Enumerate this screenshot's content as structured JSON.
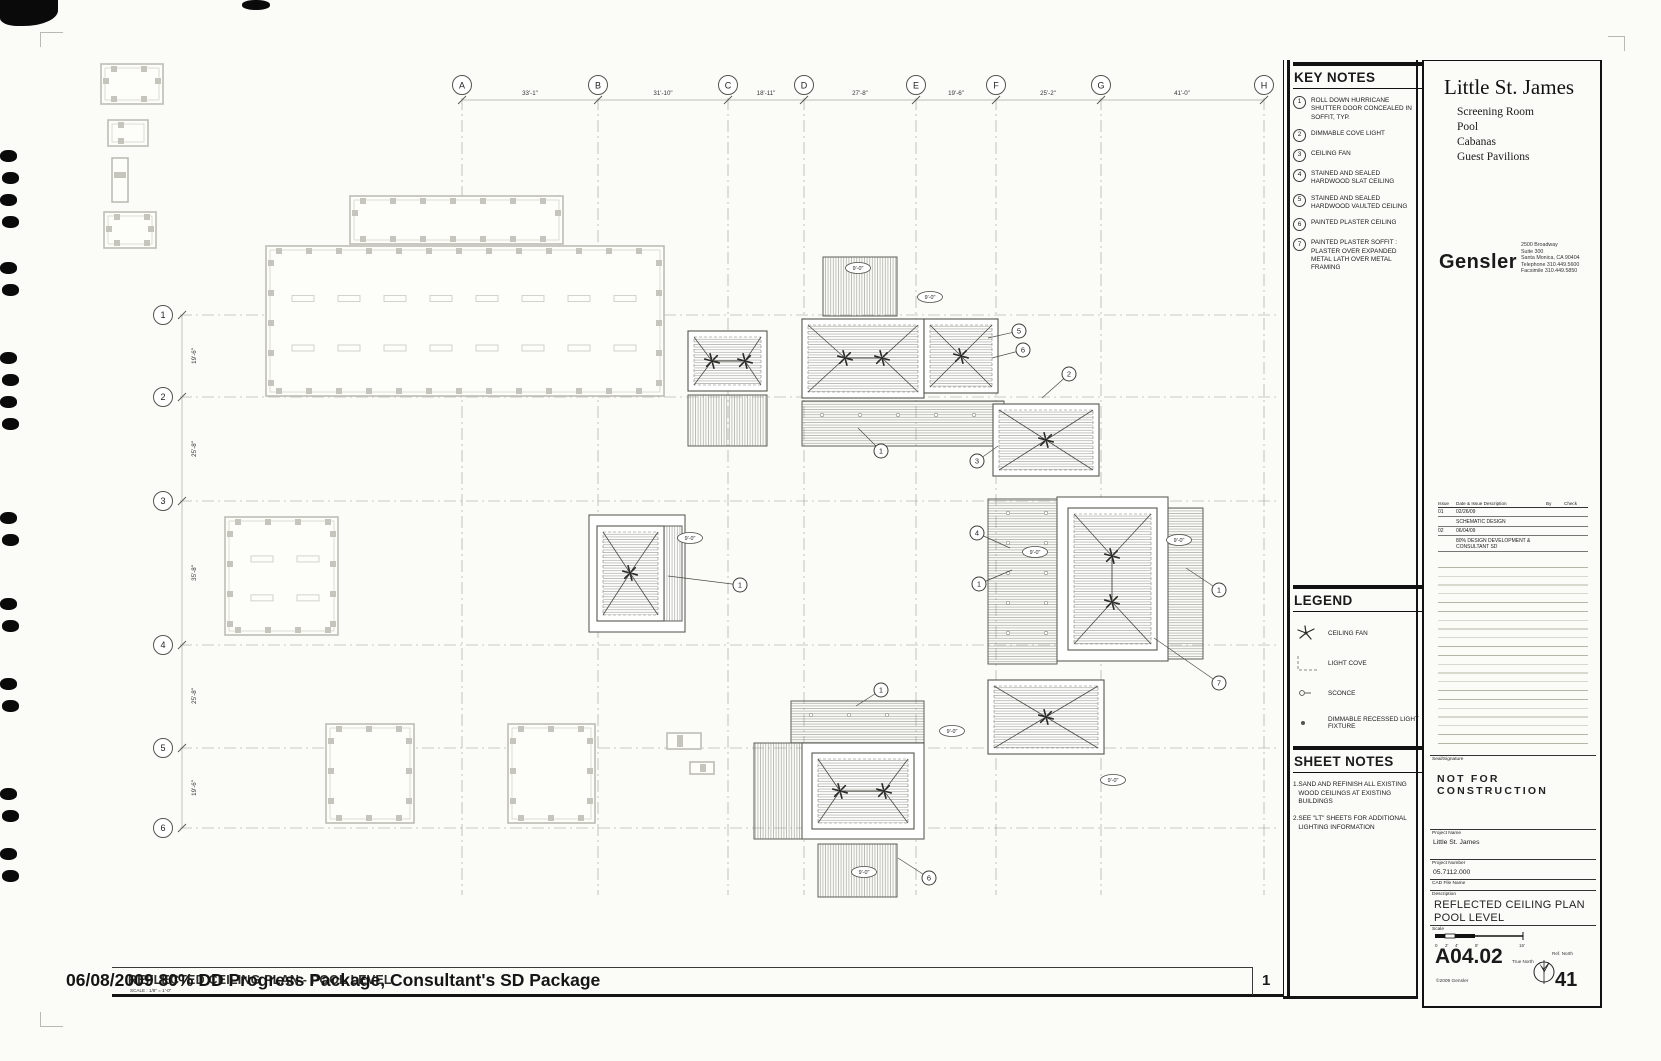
{
  "colors": {
    "ink": "#1a1a1a",
    "plan_line": "#55554f",
    "existing_gray": "#bdbdb5",
    "hatch": "#90908a"
  },
  "sheet": {
    "stamp_overlay": "06/08/2009 80% DD Progress Package, Consultant's SD Package",
    "drawing_title": "REFLECTED CEILING PLAN - POOL LEVEL",
    "drawing_scale_note": "SCALE : 1/8\" = 1'-0\"",
    "detail_number": "1"
  },
  "key_notes": {
    "title": "KEY NOTES",
    "items": [
      {
        "num": "1",
        "text": "ROLL DOWN HURRICANE SHUTTER DOOR CONCEALED IN SOFFIT, TYP."
      },
      {
        "num": "2",
        "text": "DIMMABLE COVE LIGHT"
      },
      {
        "num": "3",
        "text": "CEILING FAN"
      },
      {
        "num": "4",
        "text": "STAINED AND SEALED HARDWOOD SLAT CEILING"
      },
      {
        "num": "5",
        "text": "STAINED AND SEALED HARDWOOD VAULTED CEILING"
      },
      {
        "num": "6",
        "text": "PAINTED PLASTER CEILING"
      },
      {
        "num": "7",
        "text": "PAINTED PLASTER SOFFIT : PLASTER OVER EXPANDED METAL LATH OVER METAL FRAMING"
      }
    ]
  },
  "legend": {
    "title": "LEGEND",
    "items": [
      {
        "symbol": "ceiling-fan",
        "label": "CEILING FAN"
      },
      {
        "symbol": "light-cove",
        "label": "LIGHT COVE"
      },
      {
        "symbol": "sconce",
        "label": "SCONCE"
      },
      {
        "symbol": "dimmable-recessed",
        "label": "DIMMABLE RECESSED LIGHT FIXTURE"
      }
    ]
  },
  "sheet_notes": {
    "title": "SHEET NOTES",
    "items": [
      {
        "num": "1.",
        "text": "SAND AND REFINISH ALL EXISTING WOOD CEILINGS AT EXISTING BUILDINGS"
      },
      {
        "num": "2.",
        "text": "SEE \"LT\" SHEETS FOR ADDITIONAL LIGHTING INFORMATION"
      }
    ]
  },
  "title_block": {
    "project_title": "Little St. James",
    "project_subtitles": [
      "Screening Room",
      "Pool",
      "Cabanas",
      "Guest Pavilions"
    ],
    "firm": "Gensler",
    "address_lines": [
      "2500 Broadway",
      "Suite 300",
      "Santa Monica, CA 90404",
      "Telephone 310.449.5600",
      "Facsimile 310.449.5850"
    ],
    "issue_table": {
      "headers": [
        "Issue",
        "Date & Issue Description",
        "By",
        "Check"
      ],
      "rows": [
        [
          "01",
          "02/26/09",
          "",
          ""
        ],
        [
          "",
          "SCHEMATIC DESIGN",
          "",
          ""
        ],
        [
          "02",
          "06/04/09",
          "",
          ""
        ],
        [
          "",
          "80% DESIGN DEVELOPMENT & CONSULTANT SD",
          "",
          ""
        ]
      ]
    },
    "seal_label": "Seal/Signature",
    "not_for_construction": "NOT FOR CONSTRUCTION",
    "project_name_label": "Project Name",
    "project_name": "Little St. James",
    "project_number_label": "Project Number",
    "project_number": "05.7112.000",
    "cad_label": "CAD File Name",
    "description_label": "Description",
    "description_line1": "REFLECTED CEILING PLAN",
    "description_line2": "POOL LEVEL",
    "scale_label": "Scale",
    "scale_ticks": [
      "0",
      "2'",
      "4'",
      "8'",
      "16'"
    ],
    "sheet_number": "A04.02",
    "copyright": "©2009 Gensler",
    "true_north_label": "True North",
    "ref_north_label": "Ref. North",
    "page_number": "41"
  },
  "grid": {
    "columns": [
      {
        "label": "A",
        "x": 462
      },
      {
        "label": "B",
        "x": 598
      },
      {
        "label": "C",
        "x": 728
      },
      {
        "label": "D",
        "x": 804
      },
      {
        "label": "E",
        "x": 916
      },
      {
        "label": "F",
        "x": 996
      },
      {
        "label": "G",
        "x": 1101
      },
      {
        "label": "H",
        "x": 1264
      }
    ],
    "col_dims": [
      {
        "text": "33'-1\"",
        "x": 530
      },
      {
        "text": "31'-10\"",
        "x": 663
      },
      {
        "text": "18'-11\"",
        "x": 766
      },
      {
        "text": "27'-8\"",
        "x": 860
      },
      {
        "text": "19'-6\"",
        "x": 956
      },
      {
        "text": "25'-2\"",
        "x": 1048
      },
      {
        "text": "41'-0\"",
        "x": 1182
      }
    ],
    "rows": [
      {
        "label": "1",
        "y": 315
      },
      {
        "label": "2",
        "y": 397
      },
      {
        "label": "3",
        "y": 501
      },
      {
        "label": "4",
        "y": 645
      },
      {
        "label": "5",
        "y": 748
      },
      {
        "label": "6",
        "y": 828
      }
    ],
    "row_dims": [
      {
        "text": "19'-6\"",
        "y": 356
      },
      {
        "text": "25'-8\"",
        "y": 449
      },
      {
        "text": "35'-8\"",
        "y": 573
      },
      {
        "text": "25'-8\"",
        "y": 696
      },
      {
        "text": "19'-6\"",
        "y": 788
      }
    ]
  },
  "plan": {
    "buildings": [
      {
        "type": "existing",
        "x": 101,
        "y": 64,
        "w": 62,
        "h": 40
      },
      {
        "type": "existing",
        "x": 108,
        "y": 120,
        "w": 40,
        "h": 26
      },
      {
        "type": "existing",
        "x": 112,
        "y": 158,
        "w": 16,
        "h": 44
      },
      {
        "type": "existing",
        "x": 104,
        "y": 212,
        "w": 52,
        "h": 36
      },
      {
        "type": "existing",
        "x": 350,
        "y": 196,
        "w": 213,
        "h": 48
      },
      {
        "type": "existing",
        "x": 266,
        "y": 246,
        "w": 398,
        "h": 150,
        "bars": true
      },
      {
        "type": "existing",
        "x": 225,
        "y": 517,
        "w": 113,
        "h": 118,
        "bars": true
      },
      {
        "type": "existing",
        "x": 326,
        "y": 724,
        "w": 88,
        "h": 99
      },
      {
        "type": "existing",
        "x": 508,
        "y": 724,
        "w": 87,
        "h": 99
      },
      {
        "type": "existing",
        "x": 667,
        "y": 733,
        "w": 34,
        "h": 16
      },
      {
        "type": "existing",
        "x": 690,
        "y": 762,
        "w": 24,
        "h": 12
      },
      {
        "type": "vault",
        "x": 688,
        "y": 331,
        "w": 79,
        "h": 60,
        "fans": [
          [
            712,
            361
          ],
          [
            745,
            361
          ]
        ]
      },
      {
        "type": "slatv",
        "x": 688,
        "y": 395,
        "w": 79,
        "h": 51
      },
      {
        "type": "slatv",
        "x": 823,
        "y": 257,
        "w": 74,
        "h": 59
      },
      {
        "type": "vault",
        "x": 802,
        "y": 319,
        "w": 122,
        "h": 79,
        "fans": [
          [
            845,
            358
          ],
          [
            882,
            358
          ]
        ]
      },
      {
        "type": "vault",
        "x": 924,
        "y": 319,
        "w": 74,
        "h": 74,
        "fans": [
          [
            961,
            356
          ]
        ]
      },
      {
        "type": "slat",
        "x": 802,
        "y": 401,
        "w": 202,
        "h": 45,
        "dots": true
      },
      {
        "type": "vault",
        "x": 993,
        "y": 404,
        "w": 106,
        "h": 72,
        "fans": [
          [
            1046,
            440
          ]
        ]
      },
      {
        "type": "slat",
        "x": 988,
        "y": 499,
        "w": 69,
        "h": 165,
        "dots": true
      },
      {
        "type": "plain",
        "x": 1057,
        "y": 497,
        "w": 111,
        "h": 164
      },
      {
        "type": "vault",
        "x": 1068,
        "y": 508,
        "w": 89,
        "h": 142,
        "fans": [
          [
            1112,
            556
          ],
          [
            1112,
            602
          ]
        ]
      },
      {
        "type": "slat",
        "x": 1168,
        "y": 508,
        "w": 35,
        "h": 151
      },
      {
        "type": "vault",
        "x": 988,
        "y": 680,
        "w": 116,
        "h": 74,
        "fans": [
          [
            1046,
            717
          ]
        ]
      },
      {
        "type": "slat",
        "x": 791,
        "y": 701,
        "w": 133,
        "h": 42,
        "dots": true
      },
      {
        "type": "slatv",
        "x": 754,
        "y": 743,
        "w": 48,
        "h": 96
      },
      {
        "type": "plain",
        "x": 802,
        "y": 743,
        "w": 122,
        "h": 96
      },
      {
        "type": "vault",
        "x": 812,
        "y": 753,
        "w": 102,
        "h": 76,
        "fans": [
          [
            840,
            791
          ],
          [
            884,
            791
          ]
        ]
      },
      {
        "type": "slatv",
        "x": 818,
        "y": 844,
        "w": 79,
        "h": 53
      },
      {
        "type": "plain",
        "x": 589,
        "y": 515,
        "w": 96,
        "h": 117
      },
      {
        "type": "vault",
        "x": 597,
        "y": 526,
        "w": 67,
        "h": 95,
        "fans": [
          [
            630,
            573
          ]
        ]
      },
      {
        "type": "slatv",
        "x": 664,
        "y": 526,
        "w": 18,
        "h": 95
      }
    ],
    "keynote_refs": [
      {
        "n": "5",
        "x": 1019,
        "y": 331,
        "lx": 988,
        "ly": 338
      },
      {
        "n": "6",
        "x": 1023,
        "y": 350,
        "lx": 992,
        "ly": 358
      },
      {
        "n": "2",
        "x": 1069,
        "y": 374,
        "lx": 1042,
        "ly": 398
      },
      {
        "n": "1",
        "x": 881,
        "y": 451,
        "lx": 858,
        "ly": 428
      },
      {
        "n": "3",
        "x": 977,
        "y": 461,
        "lx": 998,
        "ly": 446
      },
      {
        "n": "4",
        "x": 977,
        "y": 533,
        "lx": 1010,
        "ly": 548
      },
      {
        "n": "1",
        "x": 979,
        "y": 584,
        "lx": 1012,
        "ly": 570
      },
      {
        "n": "1",
        "x": 740,
        "y": 585,
        "lx": 668,
        "ly": 576
      },
      {
        "n": "1",
        "x": 1219,
        "y": 590,
        "lx": 1186,
        "ly": 568
      },
      {
        "n": "7",
        "x": 1219,
        "y": 683,
        "lx": 1154,
        "ly": 638
      },
      {
        "n": "1",
        "x": 881,
        "y": 690,
        "lx": 856,
        "ly": 706
      },
      {
        "n": "6",
        "x": 929,
        "y": 878,
        "lx": 898,
        "ly": 858
      }
    ],
    "dim_tags": {
      "label": "9'-0\"",
      "positions": [
        [
          858,
          268
        ],
        [
          930,
          297
        ],
        [
          690,
          538
        ],
        [
          1035,
          552
        ],
        [
          1179,
          540
        ],
        [
          952,
          731
        ],
        [
          1113,
          780
        ],
        [
          864,
          872
        ]
      ]
    }
  }
}
